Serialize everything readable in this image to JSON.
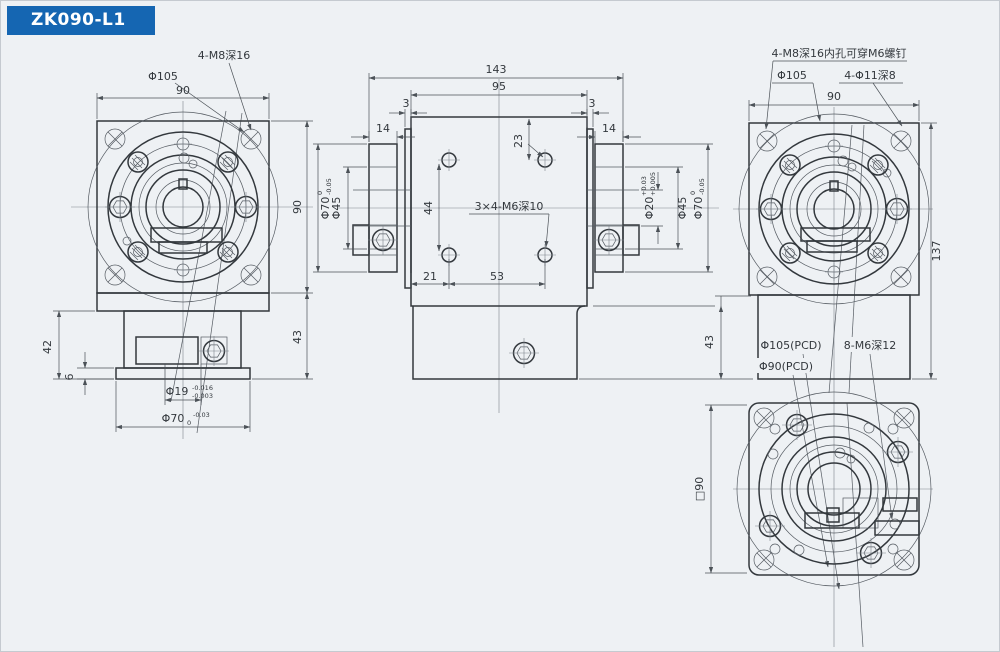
{
  "page": {
    "title": "ZK090-L1"
  },
  "colors": {
    "accent": "#1566b2",
    "background": "#eef1f4",
    "line": "#33383d"
  },
  "views": {
    "front": {
      "pcd": "Φ105",
      "taps": "4-M8深16",
      "width": "90",
      "height": "90",
      "base_height": "43",
      "base_height_left": "42",
      "lip": "6",
      "bore": {
        "main": "Φ19",
        "sup": "-0.016",
        "sub": "-0.003"
      },
      "pilot": {
        "main": "Φ70",
        "sup": "-0.03",
        "sub": "0"
      }
    },
    "side": {
      "overall_length": "143",
      "body_length": "95",
      "edge_left": "3",
      "edge_right": "3",
      "flange_left": "14",
      "flange_right": "14",
      "hole_offset_top": "23",
      "hole_offset_left": "21",
      "hole_pitch": "53",
      "center_height": "44",
      "base_height": "43",
      "shaft_left": "Φ45",
      "shaft_right": "Φ45",
      "taps": "3×4-M6深10",
      "pilot_left": {
        "main": "Φ70",
        "sup": "0",
        "sub": "-0.05"
      },
      "pilot_right": {
        "main": "Φ70",
        "sup": "0",
        "sub": "-0.05"
      },
      "input_bore": {
        "main": "Φ20",
        "sup": "+0.03",
        "sub": "+0.005"
      }
    },
    "rear": {
      "note": "4-M8深16内孔可穿M6螺钉",
      "pcd": "Φ105",
      "cbore": "4-Φ11深8",
      "width": "90",
      "height": "137",
      "base_height": "43",
      "pcd_large": "Φ105(PCD)",
      "pcd_small": "Φ90(PCD)",
      "taps": "8-M6深12"
    },
    "bottom": {
      "size": "□90"
    }
  }
}
